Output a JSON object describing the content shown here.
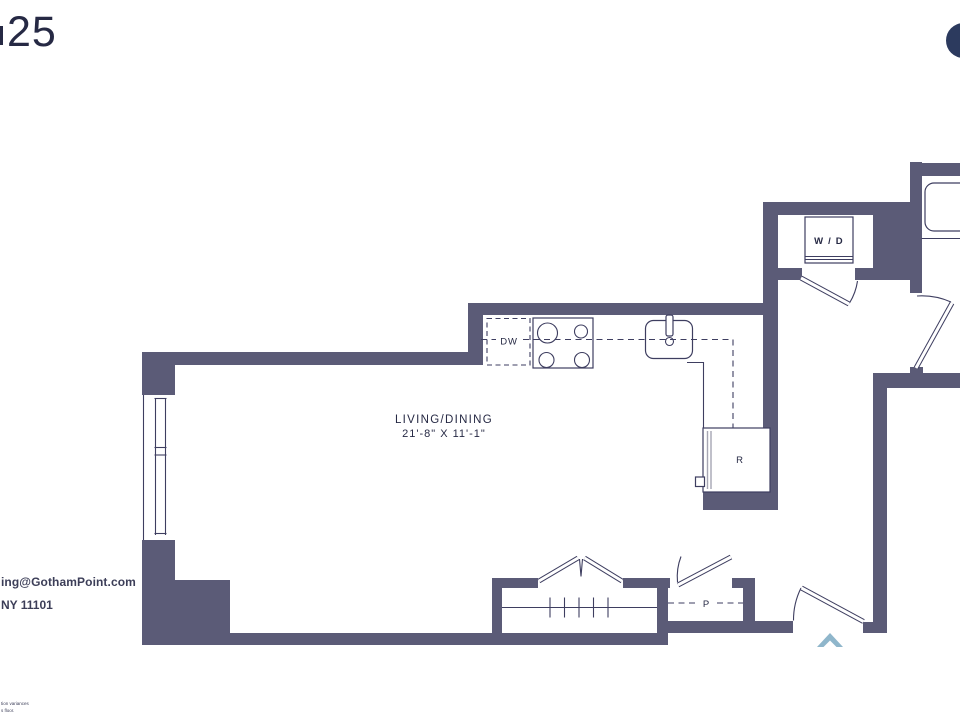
{
  "header": {
    "unit_number": "25"
  },
  "logo": {
    "name": "gotham-point-logo-circle"
  },
  "floorplan": {
    "rooms": {
      "living_dining": {
        "name": "LIVING/DINING",
        "dimensions": "21'-8\" X 11'-1\""
      }
    },
    "labels": {
      "dishwasher": "DW",
      "washer_dryer": "W / D",
      "refrigerator": "R",
      "pantry": "P"
    }
  },
  "footer": {
    "email_fragment": "ing@GothamPoint.com",
    "address_fragment": "NY 11101",
    "fineprint_line1": "tion variances",
    "fineprint_line2": "s floor."
  },
  "colors": {
    "wall": "#5b5b77",
    "line": "#3e3e60",
    "text": "#262944",
    "textsoft": "#3c3e58",
    "logo": "#2c3a5e",
    "arrow": "#8fb6cb",
    "graydoor": "#a6a6b3"
  }
}
